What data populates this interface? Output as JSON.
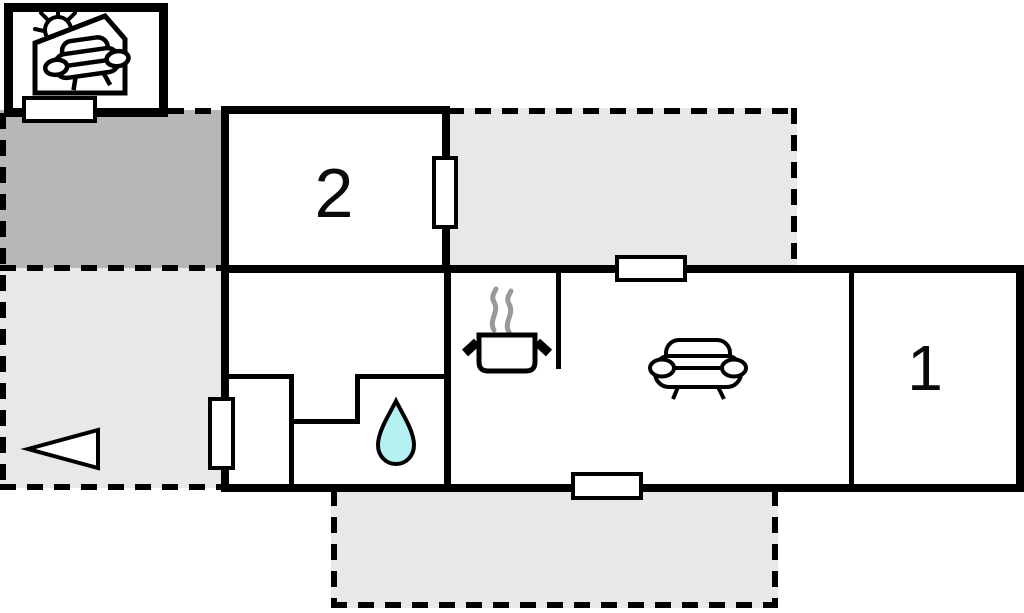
{
  "floorplan": {
    "room_labels": {
      "room2": "2",
      "room1": "1"
    },
    "colors": {
      "wall": "#000000",
      "terrace_dark": "#b7b7b7",
      "terrace_light": "#e8e8e8",
      "water_drop": "#b5f1f2",
      "steam": "#999999"
    }
  }
}
